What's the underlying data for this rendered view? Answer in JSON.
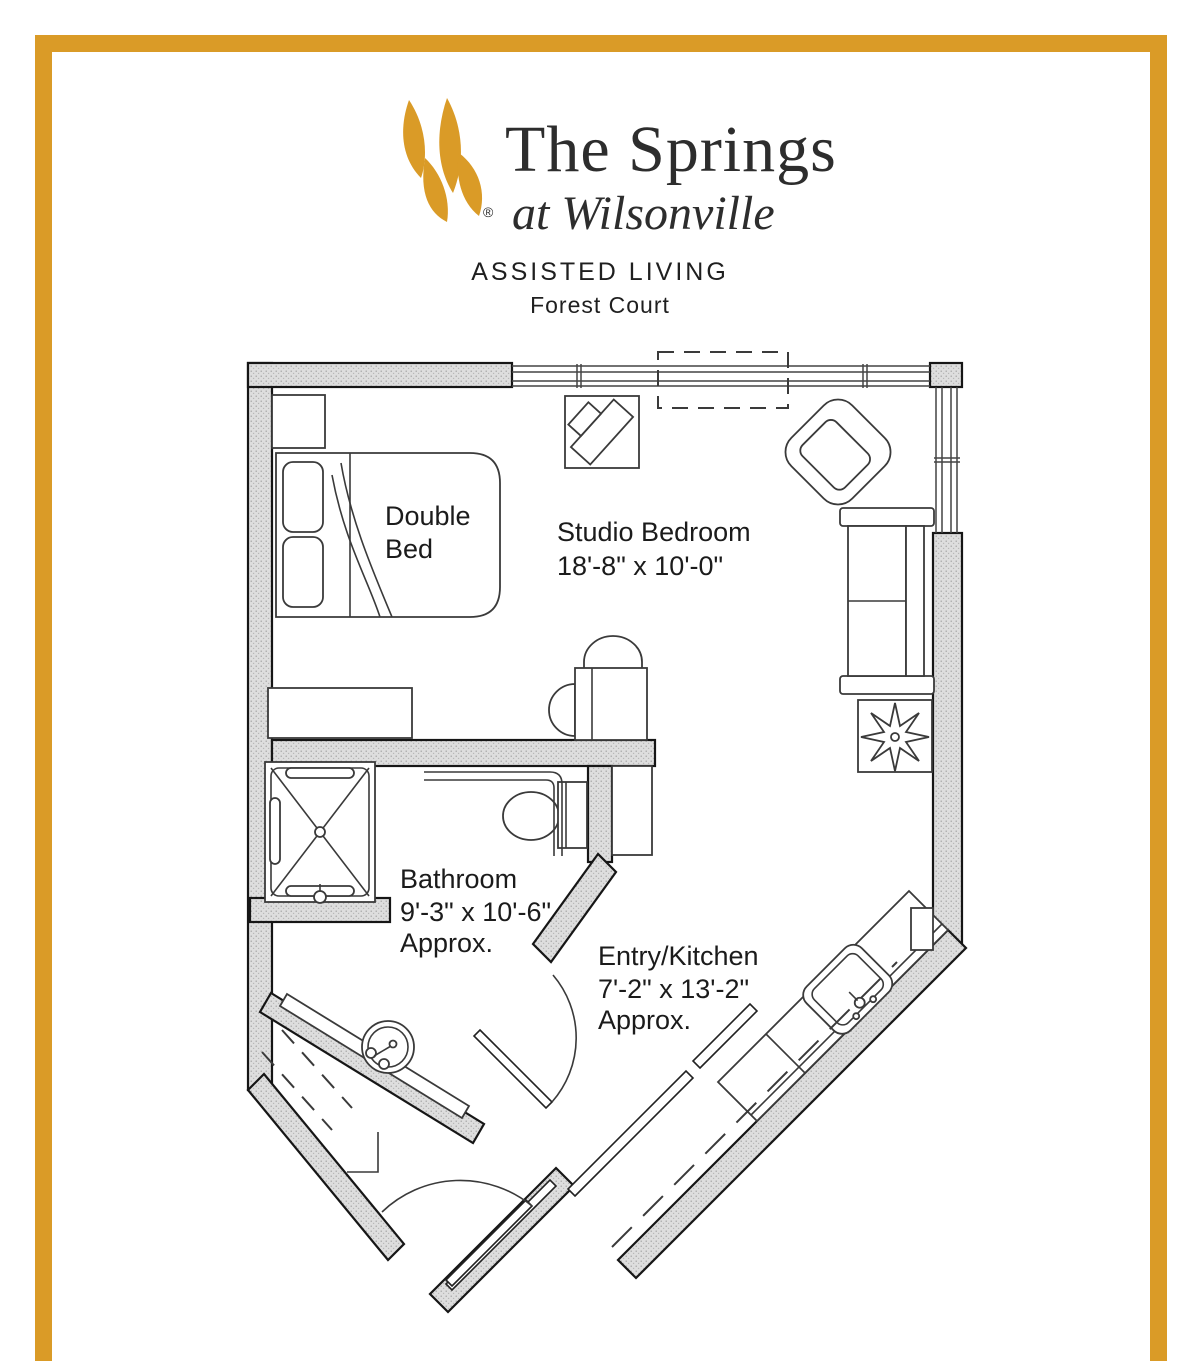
{
  "header": {
    "brand_name": "The Springs",
    "brand_location": "at Wilsonville",
    "registered_mark": "®",
    "program": "ASSISTED LIVING",
    "unit_name": "Forest Court"
  },
  "floor_plan": {
    "rooms": [
      {
        "name": "Studio Bedroom",
        "dimensions": "18'-8\" x 10'-0\"",
        "qualifier": ""
      },
      {
        "name": "Bathroom",
        "dimensions": "9'-3\" x 10'-6\"",
        "qualifier": "Approx."
      },
      {
        "name": "Entry/Kitchen",
        "dimensions": "7'-2\" x 13'-2\"",
        "qualifier": "Approx."
      }
    ],
    "furniture_labels": {
      "double_bed_line1": "Double",
      "double_bed_line2": "Bed"
    },
    "fixtures": [
      "double bed",
      "nightstand",
      "tv on stand",
      "armchair",
      "loveseat",
      "table with chairs",
      "plant",
      "dresser",
      "shower",
      "toilet",
      "vanity sink",
      "kitchen sink counter",
      "entry door",
      "bathroom door"
    ]
  },
  "colors": {
    "accent_gold": "#DA9B27",
    "wall_fill": "#DEDEDE",
    "line": "#161616"
  }
}
